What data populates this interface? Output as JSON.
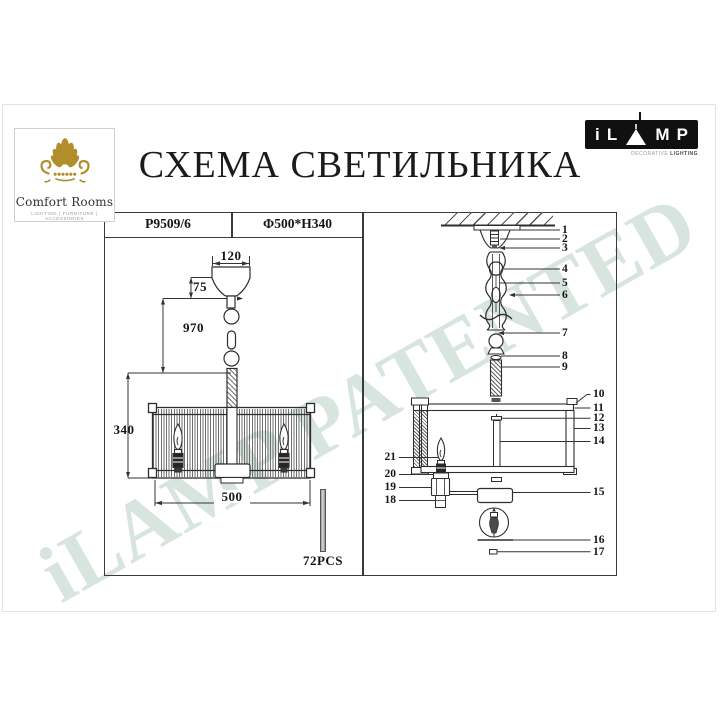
{
  "page": {
    "title": "СХЕМА СВЕТИЛЬНИКА",
    "watermark": "iLAMP PATENTED"
  },
  "logos": {
    "comfort_rooms": {
      "name": "Comfort Rooms",
      "tagline": "LIGHTING | FURNITURE | ACCESSORIES"
    },
    "ilamp": {
      "letter_i": "i",
      "letter_l": "L",
      "letter_m": "M",
      "letter_p": "P",
      "subtitle_light": "DECORATIVE ",
      "subtitle_bold": "LIGHTING"
    }
  },
  "spec_table": {
    "model": "P9509/6",
    "dimensions": "Φ500*H340"
  },
  "left_diagram": {
    "dim_canopy_width": "120",
    "dim_canopy_height": "75",
    "dim_suspension_length": "970",
    "dim_shade_height": "340",
    "dim_shade_diameter": "500",
    "glass_rod_count": "72PCS"
  },
  "right_diagram": {
    "callouts": [
      "1",
      "2",
      "3",
      "4",
      "5",
      "6",
      "7",
      "8",
      "9",
      "10",
      "11",
      "12",
      "13",
      "14",
      "15",
      "16",
      "17",
      "18",
      "19",
      "20",
      "21"
    ]
  }
}
